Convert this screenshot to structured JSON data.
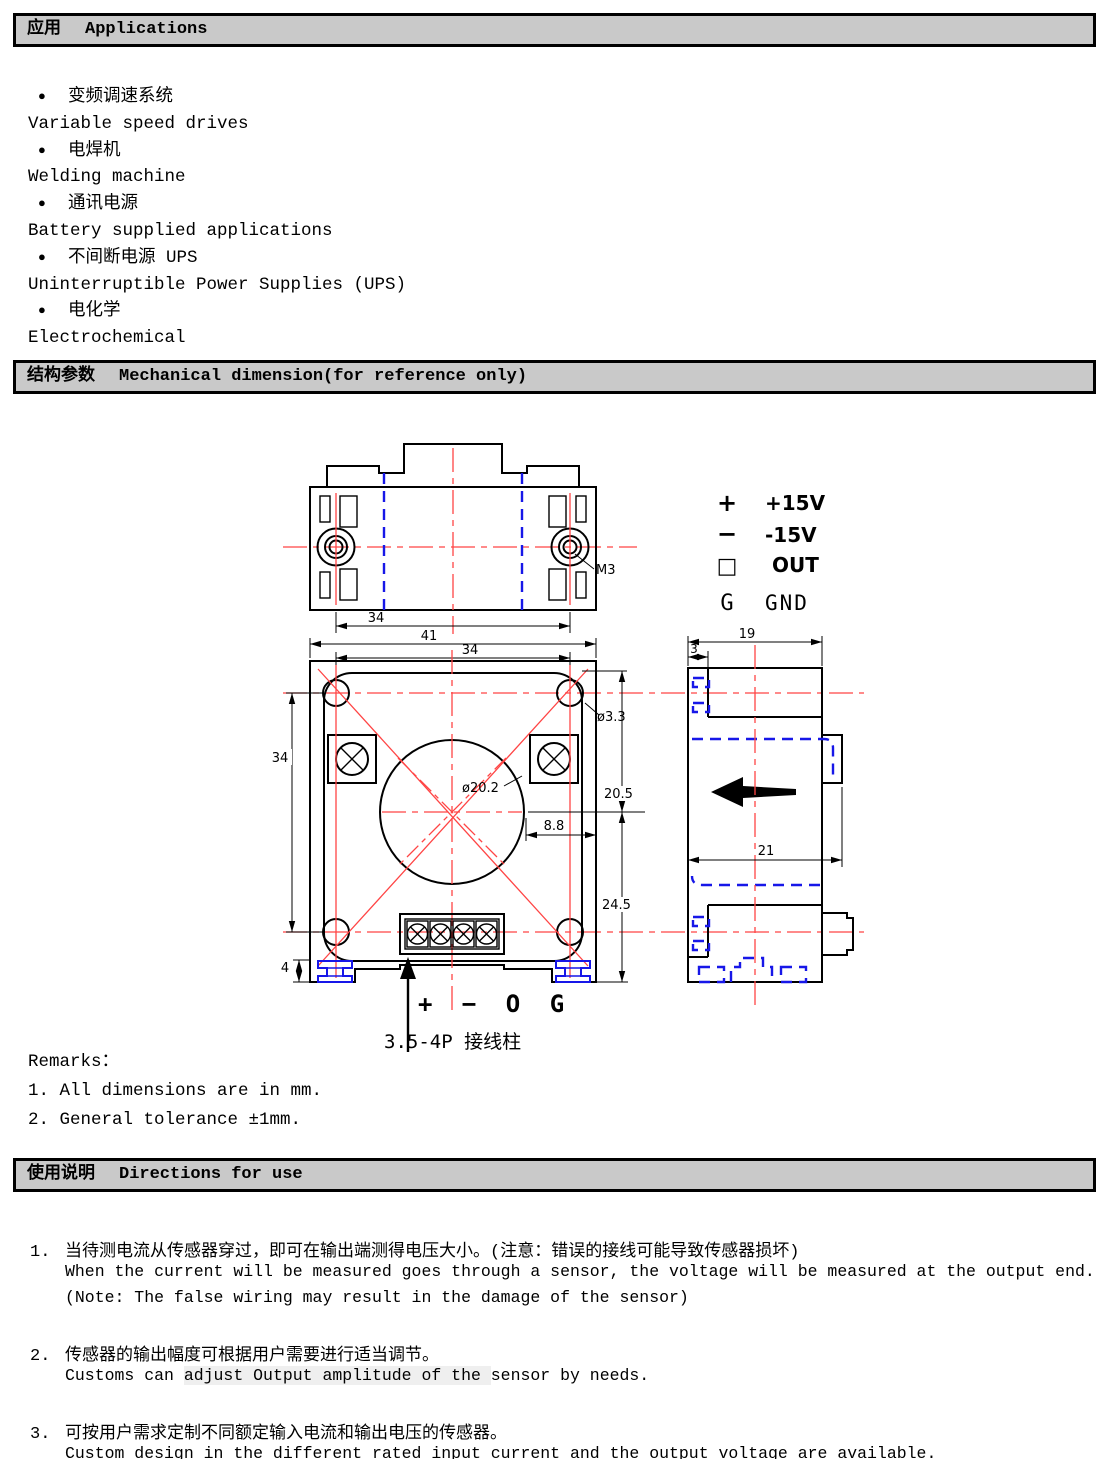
{
  "colors": {
    "header_bg": "#c9c9c9",
    "centerline_red": "#ff4545",
    "hidden_line_blue": "#1717e8",
    "line_black": "#000000"
  },
  "applications": {
    "title_zh": "应用",
    "title_en": "Applications",
    "items": [
      {
        "zh": "变频调速系统",
        "en": "Variable speed drives"
      },
      {
        "zh": "电焊机",
        "en": "Welding machine"
      },
      {
        "zh": "通讯电源",
        "en": "Battery supplied applications"
      },
      {
        "zh": "不间断电源 UPS",
        "en": "Uninterruptible Power Supplies (UPS)"
      },
      {
        "zh": "电化学",
        "en": "Electrochemical"
      }
    ]
  },
  "mechanical": {
    "title_zh": "结构参数",
    "title_en": "Mechanical dimension(for reference only)",
    "pins": [
      {
        "symbol": "+",
        "label": "+15V"
      },
      {
        "symbol": "−",
        "label": "-15V"
      },
      {
        "symbol": "□",
        "label": "OUT"
      },
      {
        "symbol": "G",
        "label": "GND"
      }
    ],
    "dims": {
      "d34_top": "34",
      "d41": "41",
      "d34_front_top": "34",
      "d34_front_left": "34",
      "d3_3": "ø3.3",
      "d20_2": "ø20.2",
      "d20_5": "20.5",
      "d8_8": "8.8",
      "d24_5": "24.5",
      "d4": "4",
      "d19": "19",
      "d3": "3",
      "d21": "21",
      "m3": "M3"
    },
    "terminal_marking": "+ − O G",
    "terminal_note": "3.5-4P 接线柱",
    "remarks_title": "Remarks：",
    "remarks": [
      "1. All dimensions are in mm.",
      "2. General tolerance ±1mm."
    ]
  },
  "directions": {
    "title_zh": "使用说明",
    "title_en": "Directions for use",
    "items": [
      {
        "num": "1.",
        "zh": "当待测电流从传感器穿过，即可在输出端测得电压大小。(注意：错误的接线可能导致传感器损坏)",
        "en1": "When the current will be measured goes through a sensor, the voltage will be measured at the output end.",
        "en2": "(Note: The false wiring may result in the damage of the sensor)"
      },
      {
        "num": "2.",
        "zh": "传感器的输出幅度可根据用户需要进行适当调节。",
        "en_pre": "Customs can ",
        "en_hl": "adjust Output amplitude of the ",
        "en_post": "sensor by needs."
      },
      {
        "num": "3.",
        "zh": "可按用户需求定制不同额定输入电流和输出电压的传感器。",
        "en1": "Custom design in the different rated input current and the output voltage are available."
      }
    ]
  }
}
